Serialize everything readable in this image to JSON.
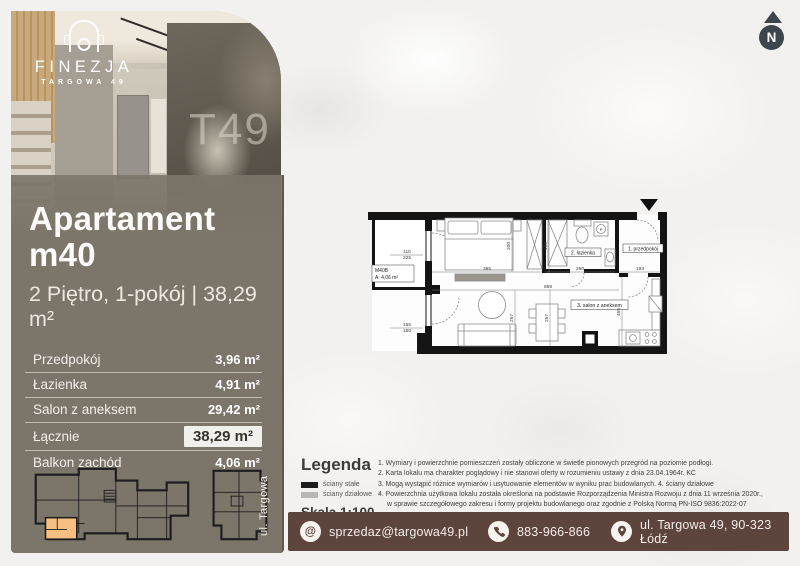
{
  "brand": {
    "name": "FINEZJA",
    "tagline": "TARGOWA 49",
    "mural_text": "T49"
  },
  "compass": {
    "label": "N"
  },
  "icons": {
    "email_glyph": "@"
  },
  "apartment": {
    "title": "Apartament m40",
    "subtitle": "2 Piętro, 1-pokój | 38,29 m²",
    "rooms": [
      {
        "label": "Przedpokój",
        "value": "3,96 m²",
        "highlight": false
      },
      {
        "label": "Łazienka",
        "value": "4,91 m²",
        "highlight": false
      },
      {
        "label": "Salon z aneksem",
        "value": "29,42 m²",
        "highlight": false
      },
      {
        "label": "Łącznie",
        "value": "38,29 m²",
        "highlight": true
      },
      {
        "label": "Balkon zachód",
        "value": "4,06 m²",
        "highlight": false
      }
    ]
  },
  "floor_plan": {
    "room_labels": [
      {
        "text": "M40B",
        "x": 15,
        "y": 79,
        "anchor": "start",
        "size": 5
      },
      {
        "text": "A: 4,06 m²",
        "x": 15,
        "y": 86,
        "anchor": "start",
        "size": 5
      },
      {
        "text": "2. łazienka",
        "x": 223,
        "y": 61.5,
        "anchor": "middle",
        "size": 5
      },
      {
        "text": "1. przedpokój",
        "x": 283,
        "y": 57.5,
        "anchor": "middle",
        "size": 5
      },
      {
        "text": "3. salon z aneksem",
        "x": 239.5,
        "y": 114,
        "anchor": "middle",
        "size": 5.2
      },
      {
        "text": "P",
        "x": 241,
        "y": 38,
        "anchor": "middle",
        "size": 3.8
      }
    ],
    "dimensions": [
      {
        "text": "395",
        "x": 127,
        "y": 77
      },
      {
        "text": "250",
        "x": 220,
        "y": 77
      },
      {
        "text": "193",
        "x": 280,
        "y": 77
      },
      {
        "text": "859",
        "x": 188,
        "y": 95
      },
      {
        "text": "200",
        "x": 150,
        "y": 53,
        "rotate": true
      },
      {
        "text": "198",
        "x": 187,
        "y": 53,
        "rotate": true
      },
      {
        "text": "465",
        "x": 260,
        "y": 119,
        "rotate": true
      },
      {
        "text": "257",
        "x": 153,
        "y": 125,
        "rotate": true
      },
      {
        "text": "257",
        "x": 188,
        "y": 125,
        "rotate": true
      },
      {
        "text": "110",
        "x": 47,
        "y": 60
      },
      {
        "text": "225",
        "x": 47,
        "y": 66
      },
      {
        "text": "155",
        "x": 47,
        "y": 133
      },
      {
        "text": "150",
        "x": 47,
        "y": 139
      }
    ]
  },
  "legend": {
    "title": "Legenda",
    "items": [
      {
        "color": "#1c1c1c",
        "label": "ściany stałe"
      },
      {
        "color": "#b9b7b4",
        "label": "ściany działowe"
      }
    ],
    "scale": "Skala 1:100"
  },
  "street_label": "ul. Targowa",
  "notes": [
    "1. Wymiary i powierzchnie pomieszczeń zostały obliczone w świetle pionowych przegród na poziomie podłogi.",
    "2. Karta lokalu ma charakter poglądowy i nie stanowi oferty w rozumieniu ustawy z dnia 23.04.1964r. KC",
    "3. Mogą wystąpić różnice wymiarów i usytuowanie elementów w wyniku prac budowlanych. 4. ściany działowe",
    "4. Powierzchnia użytkowa lokalu została określona na podstawie Rozporządzenia Ministra Rozwoju z dnia 11 września 2020r.,",
    "w sprawie szczegółowego zakresu i formy projektu budowlanego oraz zgodnie z Polską Normą PN-ISO 9836:2022-07"
  ],
  "contact": {
    "email": "sprzedaz@targowa49.pl",
    "phone": "883-966-866",
    "address": "ul. Targowa 49, 90-323 Łódź"
  },
  "colors": {
    "panel": "#7c7569",
    "bar": "#5d443c",
    "highlighted_unit": "#f6c083",
    "walls": "#141414"
  }
}
